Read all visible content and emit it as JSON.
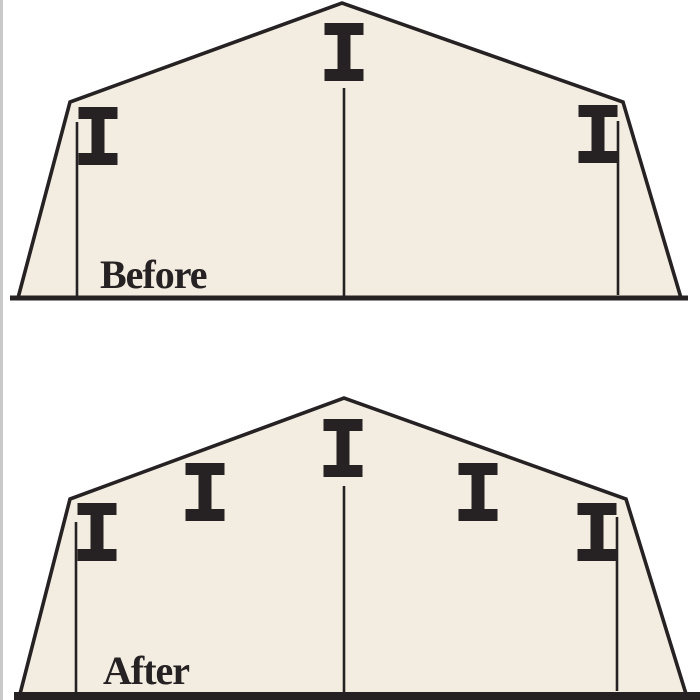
{
  "colors": {
    "background": "#ffffff",
    "shape_fill": "#f2ede0",
    "line_color": "#262122",
    "edge_strip": "#c9c9c9"
  },
  "ibeam_style": {
    "width": 39,
    "height": 58,
    "flange_thickness": 12,
    "web_thickness": 13
  },
  "stroke_widths": {
    "outline": 3.6,
    "post": 2.6
  },
  "before": {
    "label": "Before",
    "beam_count": 3,
    "outline": [
      [
        18,
        298
      ],
      [
        70,
        102
      ],
      [
        342,
        3
      ],
      [
        623,
        102
      ],
      [
        681,
        298
      ]
    ],
    "baseline": {
      "x1": 10,
      "x2": 688,
      "y": 298,
      "width": 5
    },
    "beams": [
      {
        "x": 98,
        "y": 136
      },
      {
        "x": 344,
        "y": 52
      },
      {
        "x": 598,
        "y": 134
      }
    ],
    "posts": [
      {
        "x": 77,
        "y1": 122,
        "y2": 296
      },
      {
        "x": 344,
        "y1": 88,
        "y2": 297
      },
      {
        "x": 618,
        "y1": 121,
        "y2": 295
      }
    ],
    "label_pos": {
      "x": 100,
      "y": 288
    }
  },
  "after": {
    "label": "After",
    "beam_count": 5,
    "outline": [
      [
        20,
        694
      ],
      [
        70,
        499
      ],
      [
        344,
        398
      ],
      [
        626,
        499
      ],
      [
        686,
        694
      ]
    ],
    "baseline": {
      "x1": 14,
      "x2": 700,
      "y": 696,
      "width": 8
    },
    "beams": [
      {
        "x": 97,
        "y": 532
      },
      {
        "x": 205,
        "y": 492
      },
      {
        "x": 343,
        "y": 448
      },
      {
        "x": 478,
        "y": 492
      },
      {
        "x": 597,
        "y": 532
      }
    ],
    "posts": [
      {
        "x": 76,
        "y1": 522,
        "y2": 692
      },
      {
        "x": 344,
        "y1": 486,
        "y2": 694
      },
      {
        "x": 617,
        "y1": 517,
        "y2": 691
      }
    ],
    "label_pos": {
      "x": 103,
      "y": 684
    }
  }
}
